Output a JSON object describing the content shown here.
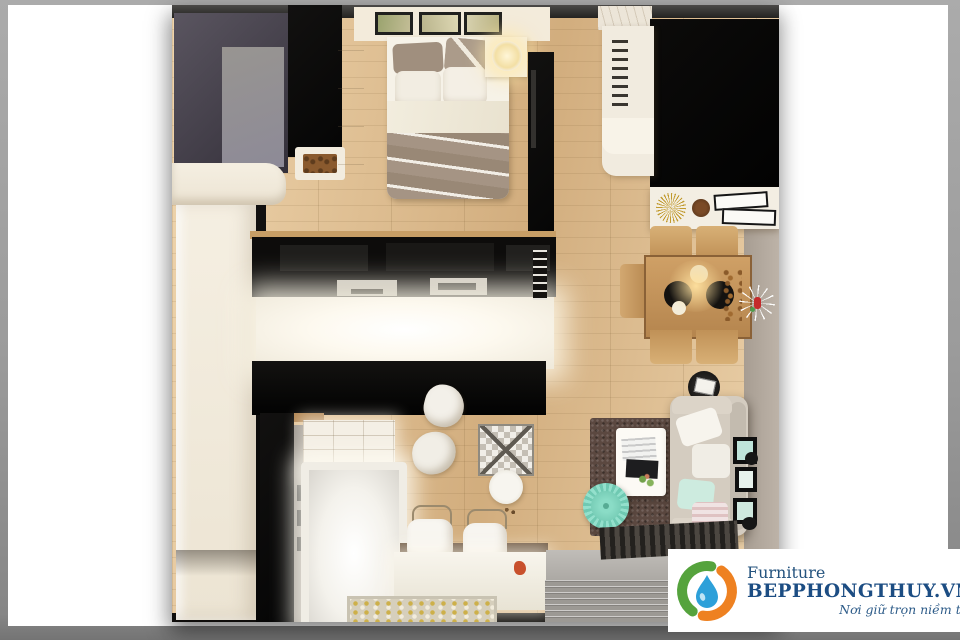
{
  "watermark": {
    "brand": "Furniture",
    "domain": "BEPPHONGTHUY.VN",
    "tagline": "Nơi giữ trọn niềm tin"
  },
  "logo_colors": {
    "leaf_green": "#55a33d",
    "flame_orange": "#ee8121",
    "water_drop_blue": "#2da0d9",
    "text_blue": "#1c4d83"
  },
  "palette": {
    "photo_frame_gray": "#9b9b9b",
    "canvas_white": "#ffffff",
    "wood_floor": "#dfbe91",
    "dark_walls": "#0d0c0b",
    "glow_white": "#fdf9ef",
    "wardrobe_gray_panel": "#908d9b",
    "taupe_blanket": "#a39382",
    "mint_accent": "#7fd3bd",
    "rug_brown": "#5b4840",
    "dining_wood": "#c89a66"
  }
}
